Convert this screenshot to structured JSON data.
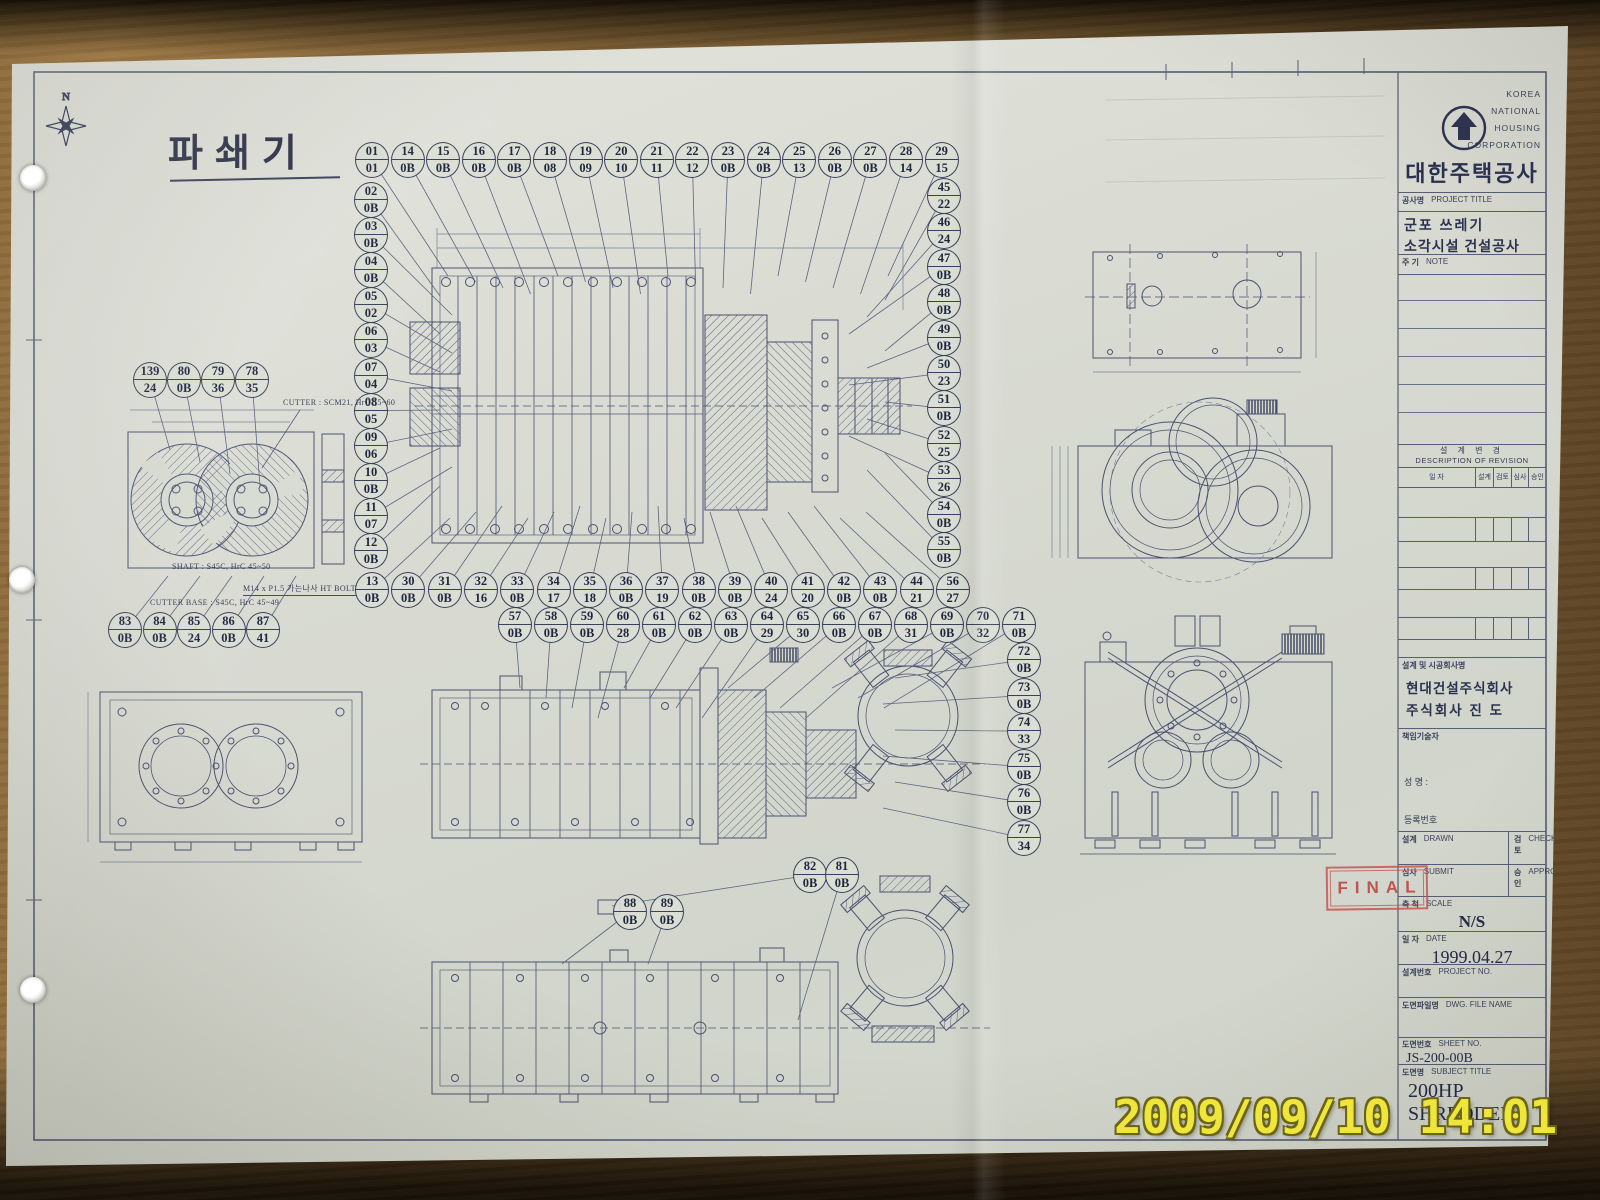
{
  "sheet": {
    "title": "파쇄기",
    "compass_label": "N"
  },
  "drawing": {
    "notes": {
      "cutter": "CUTTER : SCM21, HrC 55~60",
      "shaft": "SHAFT : S45C, HrC 45~50",
      "cutter_base": "CUTTER BASE : S45C, HrC 45~49",
      "bolt": "M14 x P1.5 가는나사 HT BOLT"
    },
    "balloons": {
      "top_row": [
        "01/01",
        "14/0B",
        "15/0B",
        "16/0B",
        "17/0B",
        "18/08",
        "19/09",
        "20/10",
        "21/11",
        "22/12",
        "23/0B",
        "24/0B",
        "25/13",
        "26/0B",
        "27/0B",
        "28/14",
        "29/15"
      ],
      "left_column": [
        "02/0B",
        "03/0B",
        "04/0B",
        "05/02",
        "06/03",
        "07/04",
        "08/05",
        "09/06",
        "10/0B",
        "11/07",
        "12/0B"
      ],
      "right_column": [
        "45/22",
        "46/24",
        "47/0B",
        "48/0B",
        "49/0B",
        "50/23",
        "51/0B",
        "52/25",
        "53/26",
        "54/0B",
        "55/0B"
      ],
      "middle_row": [
        "13/0B",
        "30/0B",
        "31/0B",
        "32/16",
        "33/0B",
        "34/17",
        "35/18",
        "36/0B",
        "37/19",
        "38/0B",
        "39/0B",
        "40/24",
        "41/20",
        "42/0B",
        "43/0B",
        "44/21",
        "56/27"
      ],
      "lower_row": [
        "57/0B",
        "58/0B",
        "59/0B",
        "60/28",
        "61/0B",
        "62/0B",
        "63/0B",
        "64/29",
        "65/30",
        "66/0B",
        "67/0B",
        "68/31",
        "69/0B",
        "70/32",
        "71/0B"
      ],
      "right_column_2": [
        "72/0B",
        "73/0B",
        "74/33",
        "75/0B",
        "76/0B",
        "77/34"
      ],
      "detail_top": [
        "139/24",
        "80/0B",
        "79/36",
        "78/35"
      ],
      "detail_bottom": [
        "83/0B",
        "84/0B",
        "85/24",
        "86/0B",
        "87/41"
      ],
      "feeder_pair": [
        "82/0B",
        "81/0B"
      ],
      "bottom_pair": [
        "88/0B",
        "89/0B"
      ]
    }
  },
  "title_block": {
    "corporation_en": [
      "KOREA",
      "NATIONAL",
      "HOUSING",
      "CORPORATION"
    ],
    "corporation_kr": "대한주택공사",
    "project": {
      "label_kr": "공사명",
      "label_en": "PROJECT TITLE",
      "value_lines": [
        "군포 쓰레기",
        "소각시설 건설공사"
      ]
    },
    "note": {
      "label_kr": "주 기",
      "label_en": "NOTE"
    },
    "revision": {
      "header_kr": "설 계 변 경",
      "header_en": "DESCRIPTION OF REVISION",
      "columns": [
        "일 자",
        "설계",
        "검토",
        "심사",
        "승인"
      ]
    },
    "company": {
      "label": "설계 및 시공회사명",
      "names": [
        "현대건설주식회사",
        "주식회사 진 도"
      ]
    },
    "engineer": {
      "label": "책임기술자",
      "name_label": "성 명 :",
      "reg_label": "등록번호"
    },
    "sign": {
      "drawn_kr": "설계",
      "drawn_en": "DRAWN",
      "check_kr": "검토",
      "check_en": "CHECK",
      "submit_kr": "심사",
      "submit_en": "SUBMIT",
      "approval_kr": "승인",
      "approval_en": "APPROVAL"
    },
    "scale": {
      "label_kr": "축 척",
      "label_en": "SCALE",
      "value": "N/S"
    },
    "date": {
      "label_kr": "일 자",
      "label_en": "DATE",
      "value": "1999.04.27"
    },
    "project_no": {
      "label_kr": "설계번호",
      "label_en": "PROJECT NO."
    },
    "dwg_file": {
      "label_kr": "도면파일명",
      "label_en": "DWG. FILE NAME"
    },
    "sheet_no": {
      "label_kr": "도면번호",
      "label_en": "SHEET NO.",
      "value": "JS-200-00B"
    },
    "subject": {
      "label_kr": "도면명",
      "label_en": "SUBJECT TITLE",
      "value_lines": [
        "200HP",
        "SHREDDER"
      ]
    }
  },
  "stamp": {
    "text": "FINAL"
  },
  "camera_timestamp": {
    "text": "2009/09/10 14:01"
  },
  "colors": {
    "paper": "#d8dbd1",
    "ink": "#4a5170",
    "wood": "#8a683a",
    "stamp_red": "#c44e4e",
    "timestamp_yellow": "#efe63c"
  }
}
